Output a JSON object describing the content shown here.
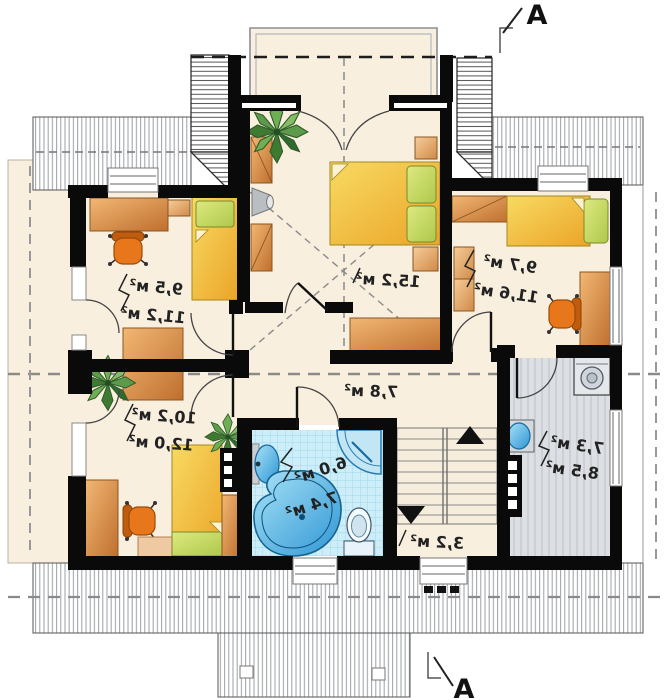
{
  "title": "attic floor plan",
  "section_markers": {
    "top": "A",
    "bottom": "A"
  },
  "rooms": {
    "bedroom_top_left": {
      "name": "bedroom",
      "areas": [
        "9,5 м²",
        "11,2 м²"
      ]
    },
    "bedroom_master": {
      "name": "bedroom",
      "areas": [
        "15,2 м²"
      ]
    },
    "bedroom_top_right": {
      "name": "bedroom",
      "areas": [
        "9,7 м²",
        "11,6 м²"
      ]
    },
    "bedroom_mid_left": {
      "name": "bedroom",
      "areas": [
        "10,2 м²",
        "12,0 м²"
      ]
    },
    "hallway": {
      "name": "hall",
      "areas": [
        "7,8 м²"
      ]
    },
    "bathroom": {
      "name": "bathroom",
      "areas": [
        "6,0 м²",
        "7,4 м²"
      ]
    },
    "staircase": {
      "name": "stairs",
      "areas": [
        "3,2 м²"
      ]
    },
    "utility_room": {
      "name": "utility",
      "areas": [
        "7,3 м²",
        "8,5 м²"
      ]
    }
  },
  "palette": {
    "floor_cream": "#f9efde",
    "wall_black": "#0a0a0a",
    "furniture_orange": "#d98c46",
    "bed_yellow": "#f2c33c",
    "pillow_green": "#c9d966",
    "chair_orange": "#e8771c",
    "bath_tile_blue": "#cdeef9",
    "fixture_blue": "#3fa3dc",
    "utility_gray": "#dcdfe3",
    "plant_green": "#4e8a3e"
  }
}
